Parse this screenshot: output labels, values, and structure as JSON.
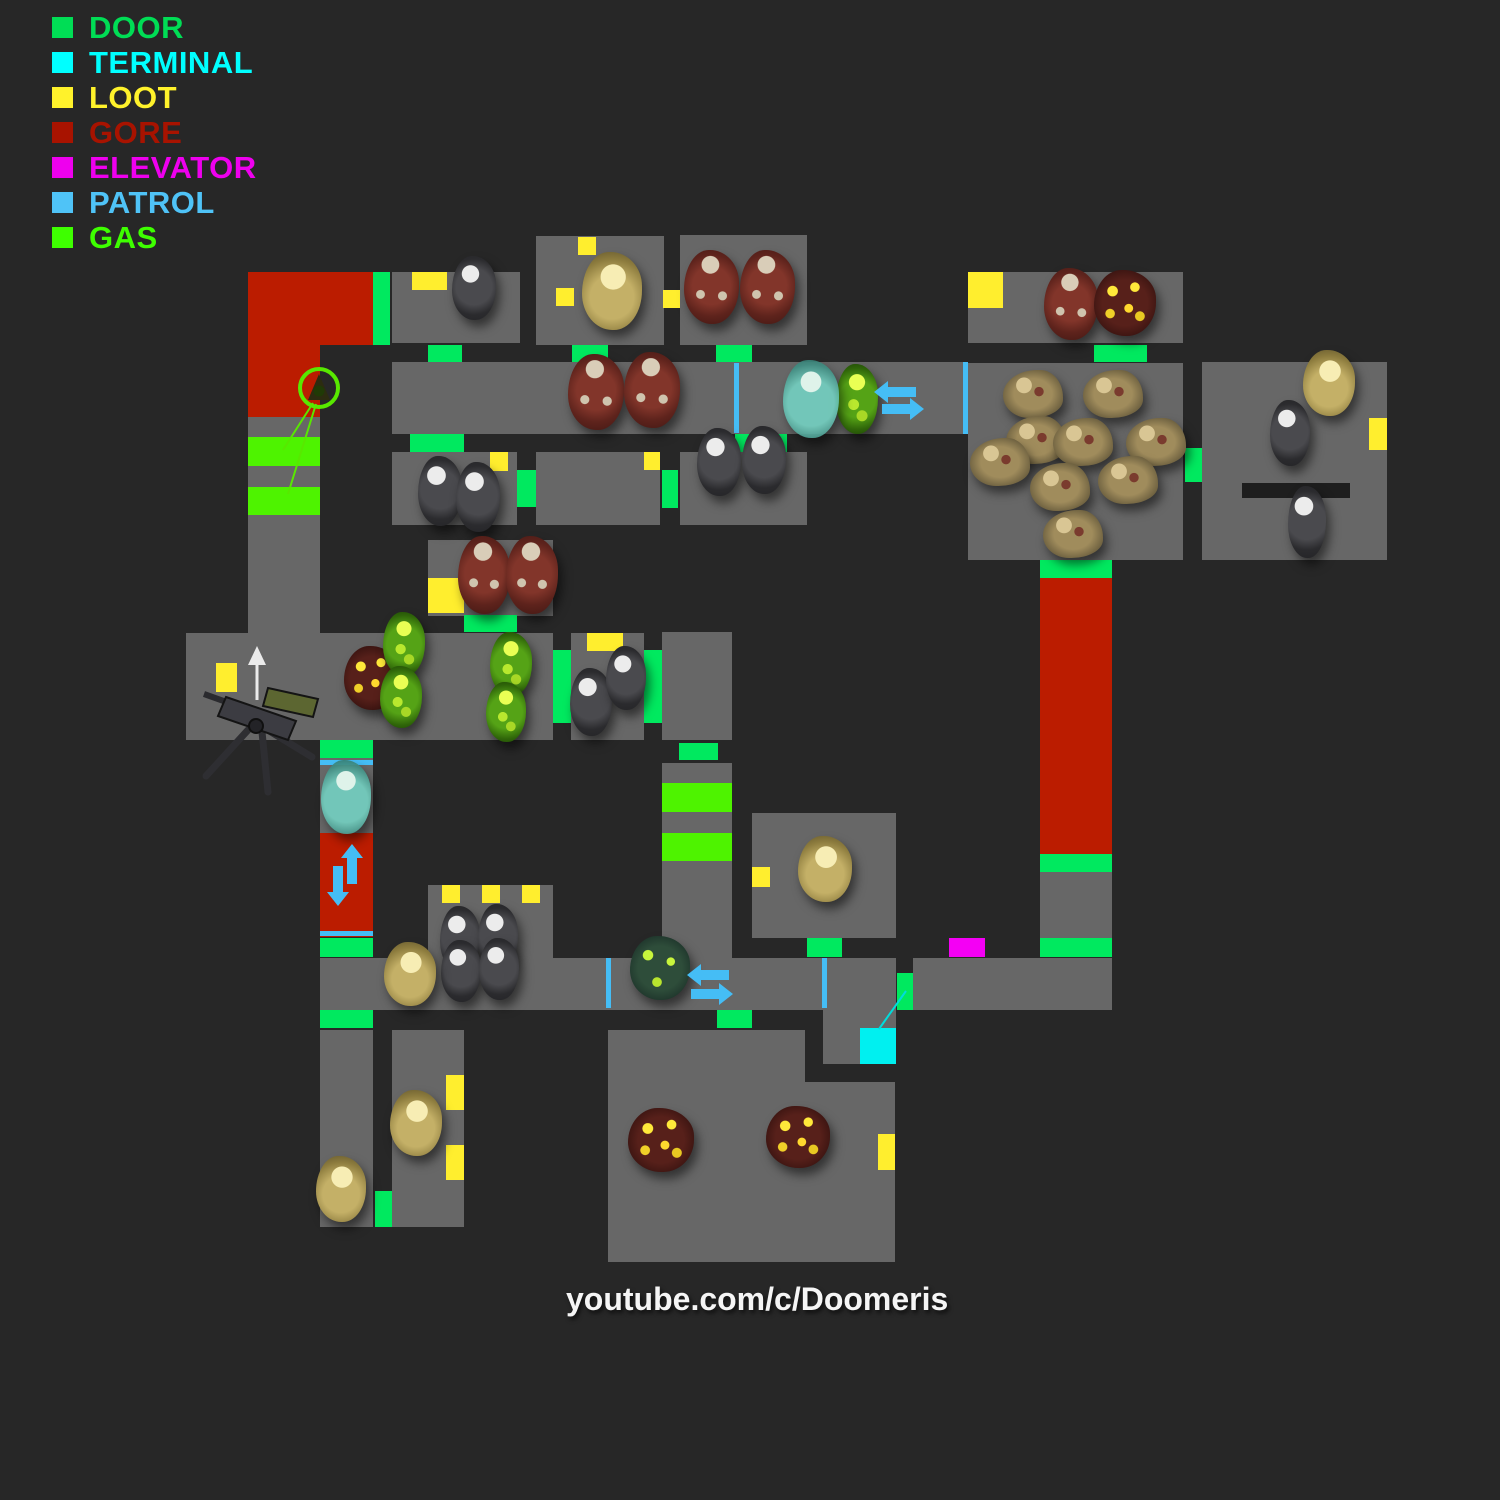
{
  "legend": {
    "items": [
      {
        "label": "DOOR",
        "color": "#00dd55"
      },
      {
        "label": "TERMINAL",
        "color": "#00ffff"
      },
      {
        "label": "LOOT",
        "color": "#fff22b"
      },
      {
        "label": "GORE",
        "color": "#a81300"
      },
      {
        "label": "ELEVATOR",
        "color": "#ee00ee"
      },
      {
        "label": "PATROL",
        "color": "#4fc3f7"
      },
      {
        "label": "GAS",
        "color": "#3eff00"
      }
    ]
  },
  "watermark": {
    "text": "youtube.com/c/Doomeris"
  },
  "map": {
    "layers": [
      {
        "cls": "floor",
        "name": "room-floor",
        "rects": [
          [
            392,
            272,
            128,
            71
          ],
          [
            536,
            236,
            128,
            109
          ],
          [
            680,
            235,
            127,
            110
          ],
          [
            968,
            272,
            215,
            71
          ],
          [
            392,
            362,
            574,
            72
          ],
          [
            392,
            452,
            125,
            73
          ],
          [
            536,
            452,
            124,
            73
          ],
          [
            680,
            452,
            127,
            73
          ],
          [
            968,
            363,
            215,
            197
          ],
          [
            1202,
            362,
            185,
            198
          ],
          [
            428,
            540,
            125,
            76
          ],
          [
            248,
            417,
            72,
            216
          ],
          [
            186,
            633,
            367,
            107
          ],
          [
            571,
            633,
            73,
            107
          ],
          [
            662,
            632,
            70,
            108
          ],
          [
            662,
            763,
            70,
            195
          ],
          [
            320,
            758,
            53,
            75
          ],
          [
            320,
            958,
            576,
            52
          ],
          [
            913,
            958,
            199,
            52
          ],
          [
            428,
            885,
            125,
            73
          ],
          [
            752,
            813,
            144,
            125
          ],
          [
            1040,
            872,
            72,
            66
          ],
          [
            320,
            1030,
            53,
            197
          ],
          [
            392,
            1030,
            72,
            197
          ],
          [
            823,
            1010,
            73,
            54
          ],
          [
            608,
            1030,
            197,
            232
          ],
          [
            805,
            1082,
            90,
            180
          ]
        ]
      },
      {
        "cls": "wall",
        "name": "inner-wall",
        "rects": [
          [
            1242,
            483,
            108,
            15
          ]
        ]
      },
      {
        "cls": "gore",
        "name": "gore-zone",
        "rects": [
          [
            248,
            272,
            125,
            73
          ],
          [
            248,
            345,
            72,
            72
          ],
          [
            320,
            833,
            53,
            104
          ],
          [
            1040,
            578,
            72,
            276
          ]
        ]
      },
      {
        "cls": "gas",
        "name": "gas-zone",
        "rects": [
          [
            248,
            437,
            72,
            29
          ],
          [
            248,
            487,
            72,
            28
          ],
          [
            662,
            783,
            70,
            29
          ],
          [
            662,
            833,
            70,
            28
          ]
        ]
      },
      {
        "cls": "door",
        "name": "door-marker",
        "rects": [
          [
            373,
            272,
            17,
            73
          ],
          [
            428,
            345,
            34,
            17
          ],
          [
            572,
            345,
            36,
            17
          ],
          [
            716,
            345,
            36,
            17
          ],
          [
            1094,
            345,
            53,
            17
          ],
          [
            410,
            434,
            54,
            18
          ],
          [
            735,
            434,
            52,
            18
          ],
          [
            517,
            470,
            19,
            37
          ],
          [
            662,
            470,
            16,
            38
          ],
          [
            1185,
            448,
            17,
            34
          ],
          [
            1040,
            560,
            72,
            18
          ],
          [
            464,
            615,
            53,
            17
          ],
          [
            553,
            650,
            18,
            73
          ],
          [
            644,
            650,
            18,
            73
          ],
          [
            320,
            740,
            53,
            18
          ],
          [
            679,
            743,
            39,
            17
          ],
          [
            1040,
            854,
            72,
            18
          ],
          [
            1040,
            938,
            72,
            19
          ],
          [
            320,
            938,
            53,
            19
          ],
          [
            897,
            973,
            16,
            37
          ],
          [
            320,
            1010,
            53,
            18
          ],
          [
            717,
            1010,
            35,
            18
          ],
          [
            375,
            1191,
            17,
            36
          ],
          [
            807,
            938,
            35,
            19
          ]
        ]
      },
      {
        "cls": "loot",
        "name": "loot-marker",
        "rects": [
          [
            412,
            272,
            35,
            18
          ],
          [
            578,
            237,
            18,
            18
          ],
          [
            556,
            288,
            18,
            18
          ],
          [
            663,
            290,
            17,
            18
          ],
          [
            968,
            272,
            35,
            36
          ],
          [
            490,
            452,
            18,
            19
          ],
          [
            644,
            452,
            16,
            18
          ],
          [
            1369,
            418,
            18,
            32
          ],
          [
            428,
            578,
            36,
            35
          ],
          [
            216,
            663,
            21,
            29
          ],
          [
            587,
            633,
            36,
            18
          ],
          [
            442,
            885,
            18,
            18
          ],
          [
            482,
            885,
            18,
            18
          ],
          [
            522,
            885,
            18,
            18
          ],
          [
            752,
            867,
            18,
            20
          ],
          [
            446,
            1075,
            18,
            35
          ],
          [
            446,
            1145,
            18,
            35
          ],
          [
            878,
            1134,
            17,
            36
          ]
        ]
      },
      {
        "cls": "elevator",
        "name": "elevator-marker",
        "rects": [
          [
            949,
            938,
            36,
            19
          ]
        ]
      },
      {
        "cls": "terminal",
        "name": "terminal-marker",
        "rects": [
          [
            860,
            1028,
            36,
            36
          ]
        ]
      },
      {
        "cls": "patrol",
        "name": "patrol-line",
        "rects": [
          [
            734,
            363,
            5,
            70
          ],
          [
            963,
            362,
            5,
            72
          ],
          [
            320,
            760,
            53,
            5
          ],
          [
            320,
            931,
            53,
            5
          ],
          [
            606,
            958,
            5,
            50
          ],
          [
            822,
            958,
            5,
            50
          ]
        ]
      }
    ],
    "enemies": [
      {
        "type": "gray",
        "name": "zombie-gray",
        "rects": [
          [
            452,
            256,
            44,
            64
          ],
          [
            418,
            456,
            44,
            70
          ],
          [
            456,
            462,
            44,
            70
          ],
          [
            697,
            428,
            44,
            68
          ],
          [
            742,
            426,
            44,
            68
          ],
          [
            570,
            668,
            42,
            68
          ],
          [
            606,
            646,
            40,
            64
          ],
          [
            440,
            906,
            40,
            66
          ],
          [
            478,
            904,
            40,
            66
          ],
          [
            441,
            940,
            40,
            62
          ],
          [
            479,
            938,
            40,
            62
          ],
          [
            1270,
            400,
            40,
            66
          ],
          [
            1288,
            486,
            38,
            72
          ]
        ]
      },
      {
        "type": "red",
        "name": "zombie-heavy",
        "rects": [
          [
            684,
            250,
            55,
            74
          ],
          [
            740,
            250,
            55,
            74
          ],
          [
            568,
            354,
            56,
            76
          ],
          [
            624,
            352,
            56,
            76
          ],
          [
            458,
            536,
            52,
            78
          ],
          [
            506,
            536,
            52,
            78
          ],
          [
            1044,
            268,
            54,
            72
          ]
        ]
      },
      {
        "type": "yellow",
        "name": "zombie-fat",
        "rects": [
          [
            582,
            252,
            60,
            78
          ],
          [
            1303,
            350,
            52,
            66
          ],
          [
            384,
            942,
            52,
            64
          ],
          [
            798,
            836,
            54,
            66
          ],
          [
            390,
            1090,
            52,
            66
          ],
          [
            316,
            1156,
            50,
            66
          ]
        ]
      },
      {
        "type": "gore",
        "name": "zombie-boomer",
        "rects": [
          [
            1094,
            270,
            62,
            66
          ],
          [
            344,
            646,
            56,
            64
          ],
          [
            628,
            1108,
            66,
            64
          ],
          [
            766,
            1106,
            64,
            62
          ]
        ]
      },
      {
        "type": "gas",
        "name": "gas-soldier",
        "rects": [
          [
            383,
            612,
            42,
            64
          ],
          [
            380,
            666,
            42,
            62
          ],
          [
            490,
            632,
            42,
            64
          ],
          [
            486,
            682,
            40,
            60
          ],
          [
            836,
            364,
            42,
            70
          ]
        ]
      },
      {
        "type": "cyan",
        "name": "zombie-spectral",
        "rects": [
          [
            783,
            360,
            56,
            78
          ],
          [
            321,
            760,
            50,
            74
          ]
        ]
      },
      {
        "type": "swamp",
        "name": "zombie-toxic",
        "rects": [
          [
            630,
            936,
            60,
            64
          ]
        ]
      },
      {
        "type": "crawler",
        "name": "zombie-crawler",
        "rects": [
          [
            1003,
            370,
            60,
            48
          ],
          [
            1083,
            370,
            60,
            48
          ],
          [
            1006,
            416,
            60,
            48
          ],
          [
            1053,
            418,
            60,
            48
          ],
          [
            1126,
            418,
            60,
            48
          ],
          [
            970,
            438,
            60,
            48
          ],
          [
            1030,
            463,
            60,
            48
          ],
          [
            1098,
            456,
            60,
            48
          ],
          [
            1043,
            510,
            60,
            48
          ]
        ]
      }
    ],
    "svg": [
      {
        "t": "circle",
        "n": "gas-marker-icon",
        "cx": 319,
        "cy": 388,
        "r": 19,
        "fill": "none",
        "stroke": "#58e800",
        "stroke-width": 4
      },
      {
        "t": "path",
        "n": "gas-marker-glyph",
        "d": "M319 374 L308 400 L330 400 Z",
        "fill": "#2c2c10"
      },
      {
        "t": "circle",
        "n": "gas-marker-glyph",
        "cx": 319,
        "cy": 391,
        "r": 5.5,
        "fill": "#203a06"
      },
      {
        "t": "line",
        "n": "gas-marker-link-line",
        "x1": 313,
        "y1": 403,
        "x2": 283,
        "y2": 450,
        "stroke": "#58e800",
        "stroke-width": 2
      },
      {
        "t": "line",
        "n": "gas-marker-link-line",
        "x1": 316,
        "y1": 404,
        "x2": 288,
        "y2": 494,
        "stroke": "#58e800",
        "stroke-width": 2
      },
      {
        "t": "line",
        "n": "terminal-link-line",
        "x1": 879,
        "y1": 1029,
        "x2": 906,
        "y2": 991,
        "stroke": "#00dcdc",
        "stroke-width": 2
      },
      {
        "t": "polygon",
        "n": "patrol-arrow-left",
        "points": "874,392 888,381 888,387 916,387 916,397 888,397 888,403",
        "fill": "#45bdf5"
      },
      {
        "t": "polygon",
        "n": "patrol-arrow-right",
        "points": "924,409 910,398 910,404 882,404 882,414 910,414 910,420",
        "fill": "#45bdf5"
      },
      {
        "t": "polygon",
        "n": "patrol-arrow-up",
        "points": "352,844 341,858 347,858 347,884 357,884 357,858 363,858",
        "fill": "#45bdf5"
      },
      {
        "t": "polygon",
        "n": "patrol-arrow-down",
        "points": "338,906 349,892 343,892 343,866 333,866 333,892 327,892",
        "fill": "#45bdf5"
      },
      {
        "t": "polygon",
        "n": "patrol-arrow-left",
        "points": "687,975 701,964 701,970 729,970 729,980 701,980 701,986",
        "fill": "#45bdf5"
      },
      {
        "t": "polygon",
        "n": "patrol-arrow-right",
        "points": "733,994 719,983 719,989 691,989 691,999 719,999 719,1005",
        "fill": "#45bdf5"
      },
      {
        "t": "line",
        "n": "turret-leg",
        "x1": 248,
        "y1": 730,
        "x2": 206,
        "y2": 776,
        "stroke": "#2e2e32",
        "stroke-width": 7,
        "stroke-linecap": "round"
      },
      {
        "t": "line",
        "n": "turret-leg",
        "x1": 262,
        "y1": 732,
        "x2": 268,
        "y2": 792,
        "stroke": "#2e2e32",
        "stroke-width": 7,
        "stroke-linecap": "round"
      },
      {
        "t": "line",
        "n": "turret-leg",
        "x1": 258,
        "y1": 724,
        "x2": 312,
        "y2": 757,
        "stroke": "#2e2e32",
        "stroke-width": 7,
        "stroke-linecap": "round"
      },
      {
        "t": "line",
        "n": "turret-barrel",
        "x1": 232,
        "y1": 704,
        "x2": 204,
        "y2": 694,
        "stroke": "#2a2a2e",
        "stroke-width": 6
      },
      {
        "t": "polygon",
        "n": "turret-body",
        "points": "226,697 296,721 288,740 218,716",
        "fill": "#3c3c42",
        "stroke": "#141414",
        "stroke-width": 2
      },
      {
        "t": "polygon",
        "n": "turret-ammo-box",
        "points": "268,688 318,699 313,717 263,706",
        "fill": "#5c6631",
        "stroke": "#141414",
        "stroke-width": 2
      },
      {
        "t": "circle",
        "n": "turret-pivot",
        "cx": 256,
        "cy": 726,
        "r": 7,
        "fill": "#232327",
        "stroke": "#101010",
        "stroke-width": 2
      },
      {
        "t": "line",
        "n": "turret-direction-arrow",
        "x1": 257,
        "y1": 700,
        "x2": 257,
        "y2": 658,
        "stroke": "#ebebeb",
        "stroke-width": 3
      },
      {
        "t": "polygon",
        "n": "turret-direction-arrow-head",
        "points": "257,646 248,665 266,665",
        "fill": "#ebebeb"
      }
    ]
  }
}
